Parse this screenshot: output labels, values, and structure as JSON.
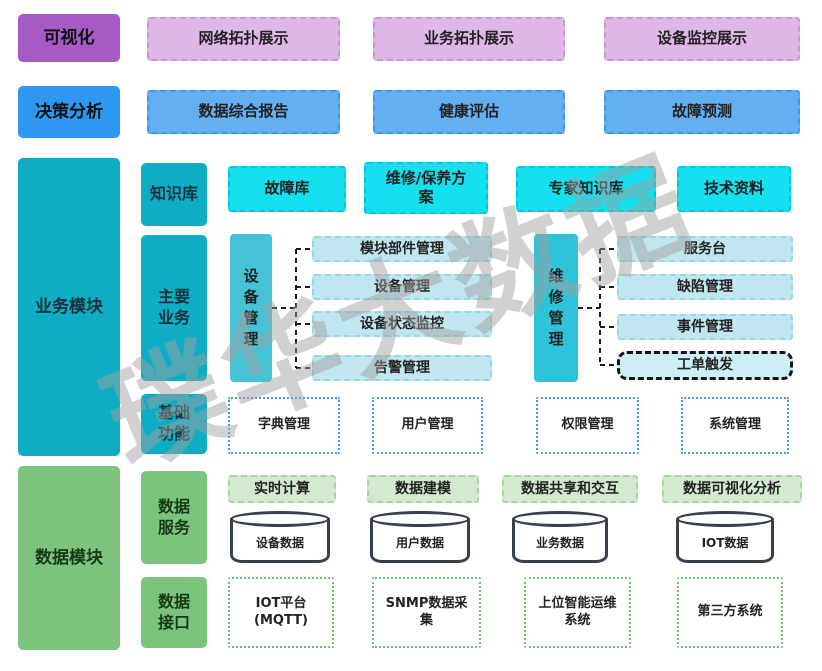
{
  "watermark": {
    "text": "璞华大数据"
  },
  "layers": {
    "visualization": {
      "label": "可视化",
      "items": [
        "网络拓扑展示",
        "业务拓扑展示",
        "设备监控展示"
      ]
    },
    "decision": {
      "label": "决策分析",
      "items": [
        "数据综合报告",
        "健康评估",
        "故障预测"
      ]
    },
    "business": {
      "label": "业务模块",
      "knowledge": {
        "label": "知识库",
        "items": [
          "故障库",
          "维修/保养方\n案",
          "专家知识库",
          "技术资料"
        ]
      },
      "main": {
        "label": "主要\n业务",
        "device": {
          "label": "设\n备\n管\n理",
          "items": [
            "模块部件管理",
            "设备管理",
            "设备状态监控",
            "告警管理"
          ]
        },
        "repair": {
          "label": "维\n修\n管\n理",
          "items": [
            "服务台",
            "缺陷管理",
            "事件管理",
            "工单触发"
          ]
        }
      },
      "basic": {
        "label": "基础\n功能",
        "items": [
          "字典管理",
          "用户管理",
          "权限管理",
          "系统管理"
        ]
      }
    },
    "data": {
      "label": "数据模块",
      "services": {
        "label": "数据\n服务",
        "items": [
          "实时计算",
          "数据建模",
          "数据共享和交互",
          "数据可视化分析"
        ],
        "databases": [
          "设备数据",
          "用户数据",
          "业务数据",
          "IOT数据"
        ]
      },
      "interfaces": {
        "label": "数据\n接口",
        "items": [
          "IOT平台\n(MQTT)",
          "SNMP数据采\n集",
          "上位智能运维\n系统",
          "第三方系统"
        ]
      }
    }
  },
  "colors": {
    "purple": "#a55ac6",
    "purple_light": "#deb7e7",
    "blue": "#2d97f1",
    "blue_light": "#64aef2",
    "teal": "#0fadc5",
    "cyan_bright": "#15e0f0",
    "teal_mid": "#45c2d6",
    "cyan_item": "#c0e7ef",
    "work_order_fill": "#cdeef4",
    "dotted_blue_border": "#3e9af0",
    "green": "#7cc47e",
    "green_light": "#d3ead1",
    "dotted_green_border": "#6cbf74",
    "cylinder_outline": "#36404e",
    "watermark_gray": "#a0a0a0"
  }
}
